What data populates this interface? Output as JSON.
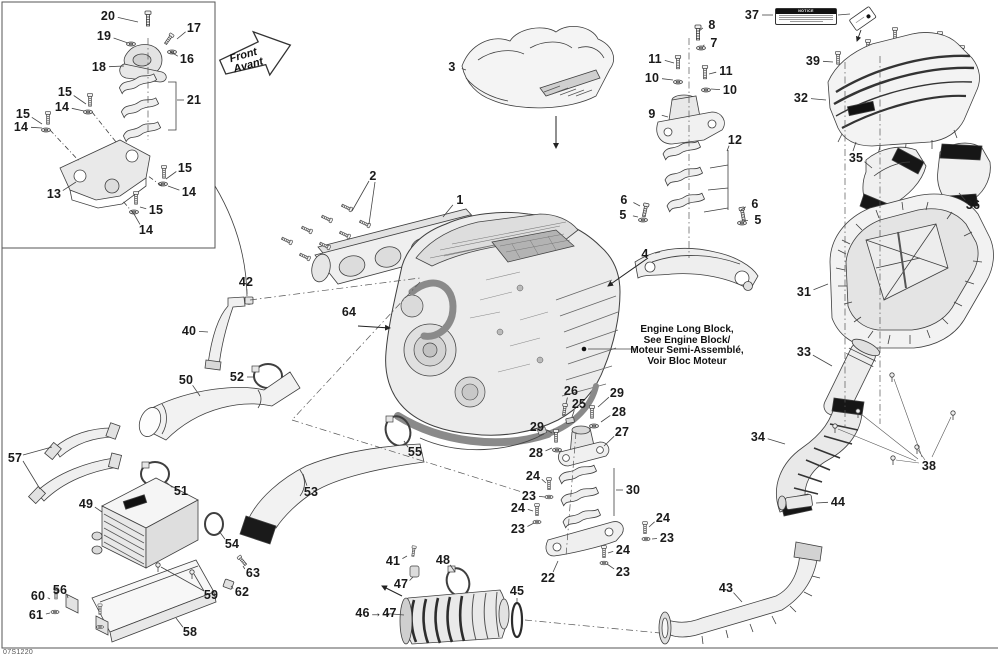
{
  "diagram": {
    "code": "07S1220",
    "front_arrow": {
      "line1": "Front",
      "line2": "Avant"
    },
    "notice": {
      "title": "NOTICE"
    },
    "engine_note": {
      "line1": "Engine Long Block,",
      "line2": "See Engine Block/",
      "line3": "Moteur Semi-Assemblé,",
      "line4": "Voir Bloc Moteur"
    }
  },
  "callouts": [
    {
      "label": "20",
      "x": 108,
      "y": 16,
      "line": [
        138,
        22
      ]
    },
    {
      "label": "19",
      "x": 104,
      "y": 36,
      "line": [
        128,
        43
      ]
    },
    {
      "label": "17",
      "x": 194,
      "y": 28,
      "line": [
        177,
        39
      ]
    },
    {
      "label": "16",
      "x": 187,
      "y": 59,
      "line": [
        171,
        52
      ]
    },
    {
      "label": "18",
      "x": 99,
      "y": 67,
      "line": [
        124,
        66
      ]
    },
    {
      "label": "21",
      "x": 194,
      "y": 100,
      "line": [
        177,
        100
      ]
    },
    {
      "label": "15",
      "x": 65,
      "y": 92,
      "line": [
        86,
        104
      ]
    },
    {
      "label": "14",
      "x": 62,
      "y": 107,
      "line": [
        84,
        111
      ]
    },
    {
      "label": "15",
      "x": 23,
      "y": 114,
      "line": [
        42,
        124
      ]
    },
    {
      "label": "14",
      "x": 21,
      "y": 127,
      "line": [
        42,
        128
      ]
    },
    {
      "label": "13",
      "x": 54,
      "y": 194,
      "line": [
        76,
        182
      ]
    },
    {
      "label": "15",
      "x": 185,
      "y": 168,
      "line": [
        166,
        179
      ]
    },
    {
      "label": "14",
      "x": 189,
      "y": 192,
      "line": [
        168,
        186
      ]
    },
    {
      "label": "15",
      "x": 156,
      "y": 210,
      "line": [
        140,
        207
      ]
    },
    {
      "label": "14",
      "x": 146,
      "y": 230,
      "line": [
        134,
        214
      ]
    },
    {
      "label": "3",
      "x": 452,
      "y": 67,
      "line": [
        466,
        70
      ]
    },
    {
      "label": "2",
      "x": 373,
      "y": 176
    },
    {
      "label": "1",
      "x": 460,
      "y": 200,
      "line": [
        443,
        217
      ]
    },
    {
      "label": "8",
      "x": 712,
      "y": 25,
      "line": [
        699,
        31
      ]
    },
    {
      "label": "7",
      "x": 714,
      "y": 43,
      "line": [
        703,
        46
      ]
    },
    {
      "label": "11",
      "x": 655,
      "y": 59,
      "line": [
        674,
        63
      ]
    },
    {
      "label": "10",
      "x": 652,
      "y": 78,
      "line": [
        673,
        80
      ]
    },
    {
      "label": "11",
      "x": 726,
      "y": 71,
      "line": [
        709,
        74
      ]
    },
    {
      "label": "10",
      "x": 730,
      "y": 90,
      "line": [
        711,
        89
      ]
    },
    {
      "label": "9",
      "x": 652,
      "y": 114,
      "line": [
        668,
        117
      ]
    },
    {
      "label": "12",
      "x": 735,
      "y": 140,
      "line": [
        727,
        151
      ]
    },
    {
      "label": "6",
      "x": 624,
      "y": 200,
      "line": [
        640,
        206
      ]
    },
    {
      "label": "5",
      "x": 623,
      "y": 215,
      "line": [
        638,
        217
      ]
    },
    {
      "label": "6",
      "x": 755,
      "y": 204,
      "line": [
        741,
        210
      ]
    },
    {
      "label": "5",
      "x": 758,
      "y": 220,
      "line": [
        743,
        221
      ]
    },
    {
      "label": "4",
      "x": 645,
      "y": 254,
      "line": [
        660,
        252
      ]
    },
    {
      "label": "37",
      "x": 752,
      "y": 15,
      "line": [
        773,
        15
      ]
    },
    {
      "label": "39",
      "x": 813,
      "y": 61,
      "line": [
        833,
        62
      ]
    },
    {
      "label": "32",
      "x": 801,
      "y": 98,
      "line": [
        826,
        100
      ]
    },
    {
      "label": "35",
      "x": 856,
      "y": 158,
      "line": [
        872,
        168
      ]
    },
    {
      "label": "36",
      "x": 973,
      "y": 205,
      "line": [
        959,
        193
      ]
    },
    {
      "label": "31",
      "x": 804,
      "y": 292,
      "line": [
        828,
        284
      ]
    },
    {
      "label": "33",
      "x": 804,
      "y": 352,
      "line": [
        832,
        366
      ]
    },
    {
      "label": "34",
      "x": 758,
      "y": 437,
      "line": [
        785,
        444
      ]
    },
    {
      "label": "38",
      "x": 929,
      "y": 466
    },
    {
      "label": "44",
      "x": 838,
      "y": 502,
      "line": [
        816,
        503
      ]
    },
    {
      "label": "43",
      "x": 726,
      "y": 588,
      "line": [
        742,
        602
      ]
    },
    {
      "label": "64",
      "x": 349,
      "y": 312
    },
    {
      "label": "42",
      "x": 246,
      "y": 282,
      "line": [
        247,
        294
      ]
    },
    {
      "label": "40",
      "x": 189,
      "y": 331,
      "line": [
        208,
        332
      ]
    },
    {
      "label": "52",
      "x": 237,
      "y": 377,
      "line": [
        254,
        377
      ]
    },
    {
      "label": "50",
      "x": 186,
      "y": 380,
      "line": [
        200,
        396
      ]
    },
    {
      "label": "55",
      "x": 415,
      "y": 452,
      "line": [
        404,
        441
      ]
    },
    {
      "label": "53",
      "x": 311,
      "y": 492,
      "line": [
        303,
        474
      ]
    },
    {
      "label": "51",
      "x": 181,
      "y": 491,
      "line": [
        166,
        482
      ]
    },
    {
      "label": "49",
      "x": 86,
      "y": 504,
      "line": [
        102,
        512
      ]
    },
    {
      "label": "57",
      "x": 15,
      "y": 458
    },
    {
      "label": "54",
      "x": 232,
      "y": 544,
      "line": [
        219,
        531
      ]
    },
    {
      "label": "63",
      "x": 253,
      "y": 573,
      "line": [
        243,
        566
      ]
    },
    {
      "label": "62",
      "x": 242,
      "y": 592,
      "line": [
        231,
        586
      ]
    },
    {
      "label": "59",
      "x": 211,
      "y": 595
    },
    {
      "label": "58",
      "x": 190,
      "y": 632,
      "line": [
        176,
        618
      ]
    },
    {
      "label": "60",
      "x": 38,
      "y": 596,
      "line": [
        50,
        599
      ]
    },
    {
      "label": "56",
      "x": 60,
      "y": 590,
      "line": [
        68,
        598
      ]
    },
    {
      "label": "61",
      "x": 36,
      "y": 615,
      "line": [
        50,
        613
      ]
    },
    {
      "label": "41",
      "x": 393,
      "y": 561,
      "line": [
        407,
        556
      ]
    },
    {
      "label": "48",
      "x": 443,
      "y": 560,
      "line": [
        455,
        572
      ]
    },
    {
      "label": "47",
      "x": 401,
      "y": 584,
      "line": [
        413,
        577
      ]
    },
    {
      "label": "46→47",
      "x": 376,
      "y": 613,
      "line": [
        404,
        615
      ]
    },
    {
      "label": "45",
      "x": 517,
      "y": 591,
      "line": [
        517,
        602
      ]
    },
    {
      "label": "22",
      "x": 548,
      "y": 578,
      "line": [
        558,
        561
      ]
    },
    {
      "label": "26",
      "x": 571,
      "y": 391,
      "line": [
        566,
        404
      ]
    },
    {
      "label": "25",
      "x": 579,
      "y": 404,
      "line": [
        572,
        417
      ]
    },
    {
      "label": "29",
      "x": 617,
      "y": 393,
      "line": [
        598,
        407
      ]
    },
    {
      "label": "28",
      "x": 619,
      "y": 412,
      "line": [
        601,
        422
      ]
    },
    {
      "label": "29",
      "x": 537,
      "y": 427,
      "line": [
        552,
        433
      ]
    },
    {
      "label": "27",
      "x": 622,
      "y": 432,
      "line": [
        604,
        446
      ]
    },
    {
      "label": "28",
      "x": 536,
      "y": 453,
      "line": [
        552,
        448
      ]
    },
    {
      "label": "24",
      "x": 533,
      "y": 476,
      "line": [
        546,
        483
      ]
    },
    {
      "label": "23",
      "x": 529,
      "y": 496,
      "line": [
        545,
        497
      ]
    },
    {
      "label": "30",
      "x": 633,
      "y": 490,
      "line": [
        616,
        490
      ]
    },
    {
      "label": "24",
      "x": 518,
      "y": 508,
      "line": [
        533,
        511
      ]
    },
    {
      "label": "23",
      "x": 518,
      "y": 529,
      "line": [
        534,
        523
      ]
    },
    {
      "label": "24",
      "x": 663,
      "y": 518,
      "line": [
        649,
        527
      ]
    },
    {
      "label": "23",
      "x": 667,
      "y": 538,
      "line": [
        652,
        539
      ]
    },
    {
      "label": "24",
      "x": 623,
      "y": 550,
      "line": [
        608,
        553
      ]
    },
    {
      "label": "23",
      "x": 623,
      "y": 572,
      "line": [
        607,
        564
      ]
    }
  ]
}
